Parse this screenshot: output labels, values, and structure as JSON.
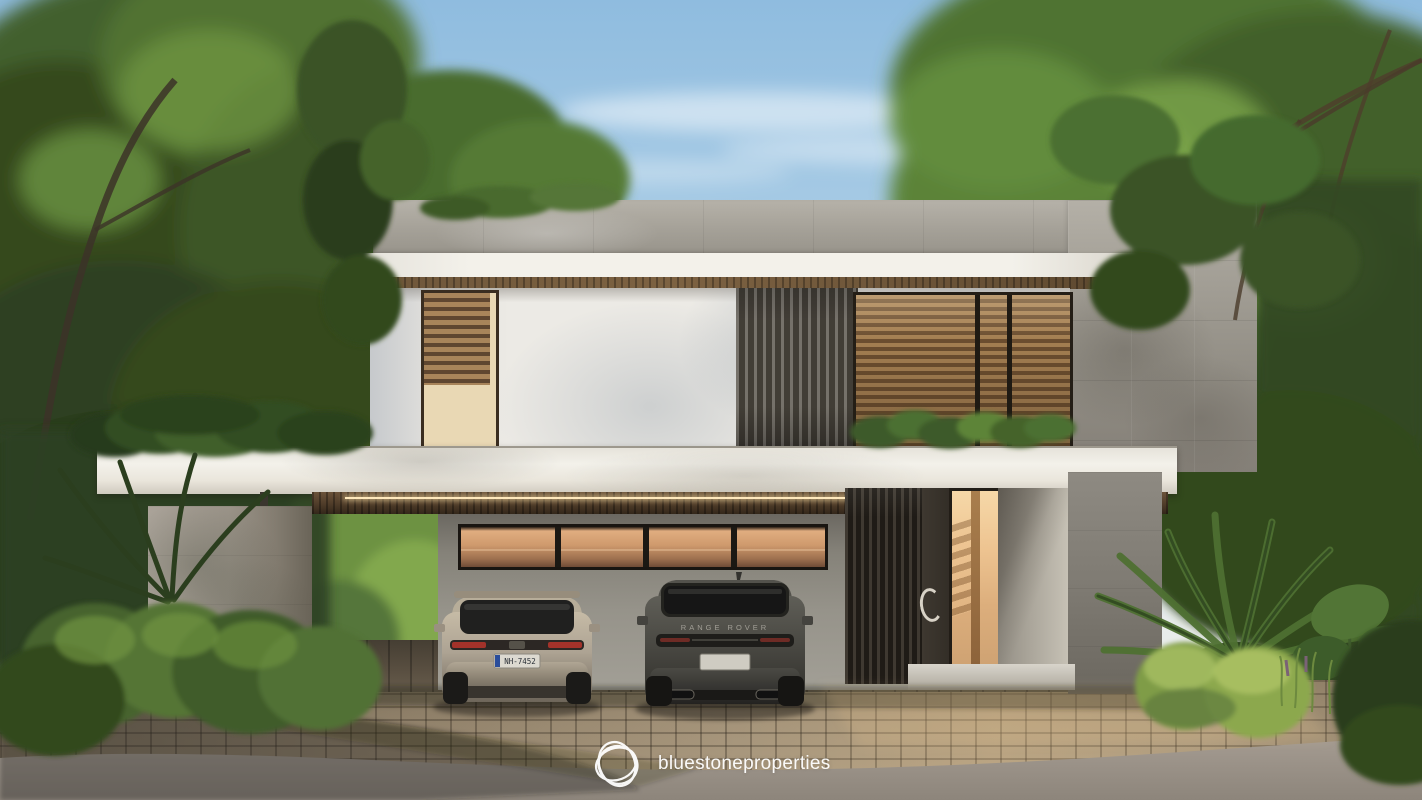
{
  "scene": {
    "description": "Photorealistic exterior render of a modern two-storey villa with cantilevered carport, wooden blinds and slat screens, two parked SUVs, cobblestone driveway and dense tropical landscaping",
    "sky": "clear blue with light wispy clouds"
  },
  "branding": {
    "logo_icon": "bluestone-swirl-logo",
    "wordmark": "bluestoneproperties",
    "color": "#ffffff"
  },
  "vehicles": [
    {
      "id": "suv-light",
      "description": "beige compact SUV, rear view",
      "body_color": "#b3a894",
      "license_plate": "NH-7452"
    },
    {
      "id": "suv-dark",
      "description": "dark grey luxury SUV, rear view",
      "body_color": "#4b4a45",
      "tailgate_badge": "RANGE ROVER",
      "license_plate": ""
    }
  ],
  "palette": {
    "sky_top": "#8fbcdf",
    "sky_low": "#e9edec",
    "concrete_parapet": "#b6b2a9",
    "concrete_tile": "#b4b0a7",
    "concrete_tile_dark": "#6b675f",
    "fascia_white": "#f3f1ea",
    "stucco": "#eceae5",
    "stucco_shadow": "#c6c9cc",
    "wood_soffit": "#5d482f",
    "blind_light": "#a8845a",
    "blind_dark": "#5f4630",
    "slat_black": "#1f1b16",
    "glass_warm": "#e0ad80",
    "glass_entry": "#eec491",
    "gf_wall": "#96938a",
    "gf_wall_dark": "#6b6861",
    "entry_wall": "#aaa59a",
    "col_left": "#aaa399",
    "col_left_dark": "#6a6458",
    "step": "#d8d4cb",
    "paver": "#94846c",
    "paver_light": "#ab9a80",
    "carport_floor": "#453e33",
    "road": "#a19890",
    "road_dark": "#8e867c",
    "foliage_deep": "#2c3e1f",
    "foliage_dark": "#3a5226",
    "foliage_mid": "#4f7030",
    "foliage_light": "#7fa84a",
    "foliage_bright": "#9cc25e",
    "branch": "#4a3b2a",
    "car_light": "#b3a894",
    "car_dark": "#4b4a45",
    "white": "#ffffff"
  }
}
